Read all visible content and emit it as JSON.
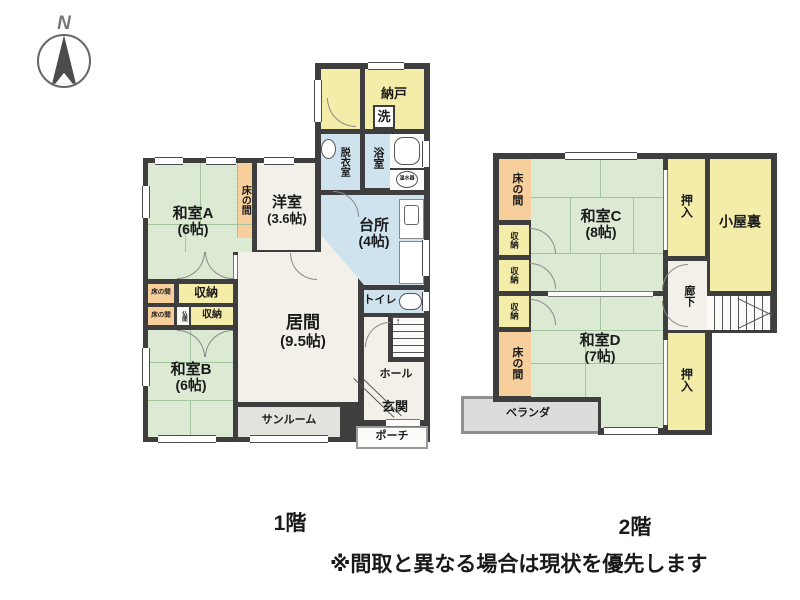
{
  "compass": {
    "north_label": "N"
  },
  "floor1": {
    "caption": "1階",
    "rooms": {
      "nando": "納戸",
      "sen": "洗",
      "datsui": "脱衣室",
      "yokushitsu": "浴室",
      "onsuiki": "温水器",
      "daidokoro": "台所",
      "daidokoro_size": "(4帖)",
      "washitsuA": "和室A",
      "washitsuA_size": "(6帖)",
      "tokonoma_strip": "床の間",
      "yoshitsu": "洋室",
      "yoshitsu_size": "(3.6帖)",
      "ima": "居間",
      "ima_size": "(9.5帖)",
      "tokonoma_small1": "床の間",
      "tokonoma_small2": "床の間",
      "shuno1": "収納",
      "butsuma": "仏間",
      "shuno2": "収納",
      "washitsuB": "和室B",
      "washitsuB_size": "(6帖)",
      "sunroom": "サンルーム",
      "toilet": "トイレ",
      "hall": "ホール",
      "genkan": "玄関",
      "porch": "ポーチ",
      "stairs_arrow": "↑"
    }
  },
  "floor2": {
    "caption": "2階",
    "rooms": {
      "tokonoma_top": "床の間",
      "shuno1": "収納",
      "shuno2": "収納",
      "shuno3": "収納",
      "tokonoma_bottom": "床の間",
      "washitsuC": "和室C",
      "washitsuC_size": "(8帖)",
      "oshiire_top": "押入",
      "koyaura": "小屋裏",
      "roka": "廊下",
      "washitsuD": "和室D",
      "washitsuD_size": "(7帖)",
      "oshiire_bottom": "押入",
      "veranda": "ベランダ"
    }
  },
  "note": "※間取と異なる場合は現状を優先します",
  "colors": {
    "wall": "#3e3e3e",
    "tatami": "#dcead3",
    "storage_yellow": "#f4eca9",
    "alcove_orange": "#f6cf9d",
    "water_blue": "#cfe3ee",
    "floor_cream": "#f2f0e9",
    "outdoor_gray": "#e2e2de"
  }
}
